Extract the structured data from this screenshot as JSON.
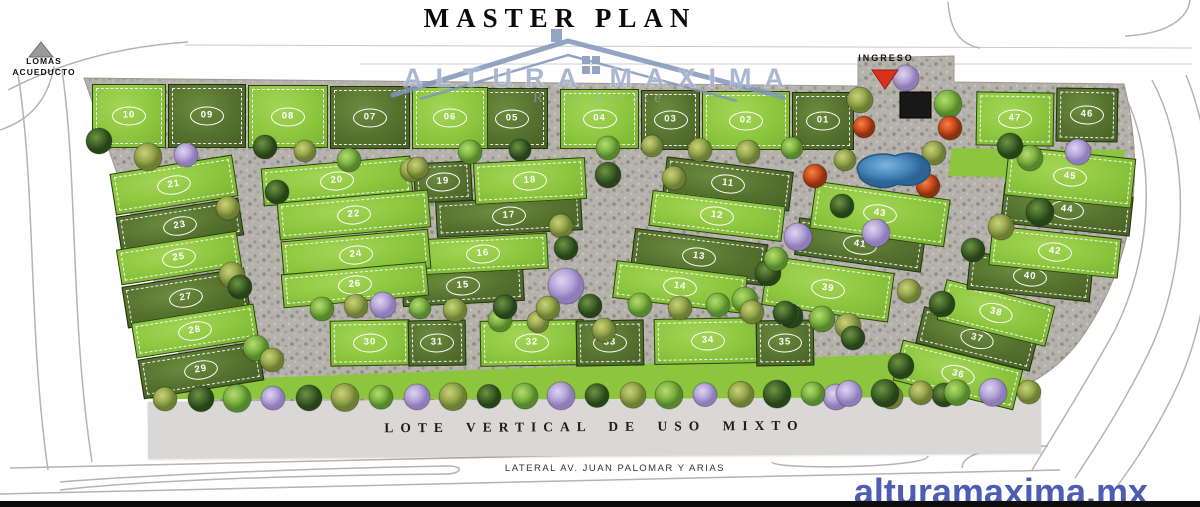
{
  "title": "MASTER PLAN",
  "brand": {
    "name": "ALTURA MAXIMA",
    "subtitle": "Real Estate",
    "website": "alturamaxima.mx"
  },
  "labels": {
    "top_left_road": "LOMAS ACUEDUCTO",
    "entrance": "INGRESO",
    "mixed_use_strip": "LOTE VERTICAL DE USO MIXTO",
    "bottom_road": "LATERAL AV. JUAN PALOMAR Y ARIAS"
  },
  "colors": {
    "lot_light": "#8cc63f",
    "lot_dark": "#55702e",
    "road": "#b5b2ab",
    "pond": "#4a89bd",
    "entrance_arrow_red": "#d8321c",
    "brand_blue": "#4d5db2",
    "watermark_blue": "#8b9abf",
    "strip_gray": "#d9d8d6"
  },
  "lots": [
    {
      "id": "01",
      "shade": "dark"
    },
    {
      "id": "02",
      "shade": "light"
    },
    {
      "id": "03",
      "shade": "dark"
    },
    {
      "id": "04",
      "shade": "light"
    },
    {
      "id": "05",
      "shade": "dark"
    },
    {
      "id": "06",
      "shade": "light"
    },
    {
      "id": "07",
      "shade": "dark"
    },
    {
      "id": "08",
      "shade": "light"
    },
    {
      "id": "09",
      "shade": "dark"
    },
    {
      "id": "10",
      "shade": "light"
    },
    {
      "id": "11",
      "shade": "dark"
    },
    {
      "id": "12",
      "shade": "light"
    },
    {
      "id": "13",
      "shade": "dark"
    },
    {
      "id": "14",
      "shade": "light"
    },
    {
      "id": "15",
      "shade": "dark"
    },
    {
      "id": "16",
      "shade": "light"
    },
    {
      "id": "17",
      "shade": "dark"
    },
    {
      "id": "18",
      "shade": "light"
    },
    {
      "id": "19",
      "shade": "dark"
    },
    {
      "id": "20",
      "shade": "light"
    },
    {
      "id": "21",
      "shade": "light"
    },
    {
      "id": "22",
      "shade": "light"
    },
    {
      "id": "23",
      "shade": "dark"
    },
    {
      "id": "24",
      "shade": "light"
    },
    {
      "id": "25",
      "shade": "light"
    },
    {
      "id": "26",
      "shade": "light"
    },
    {
      "id": "27",
      "shade": "dark"
    },
    {
      "id": "28",
      "shade": "light"
    },
    {
      "id": "29",
      "shade": "dark"
    },
    {
      "id": "30",
      "shade": "light"
    },
    {
      "id": "31",
      "shade": "dark"
    },
    {
      "id": "32",
      "shade": "light"
    },
    {
      "id": "33",
      "shade": "dark"
    },
    {
      "id": "34",
      "shade": "light"
    },
    {
      "id": "35",
      "shade": "dark"
    },
    {
      "id": "36",
      "shade": "light"
    },
    {
      "id": "37",
      "shade": "dark"
    },
    {
      "id": "38",
      "shade": "light"
    },
    {
      "id": "39",
      "shade": "light"
    },
    {
      "id": "40",
      "shade": "dark"
    },
    {
      "id": "41",
      "shade": "dark"
    },
    {
      "id": "42",
      "shade": "light"
    },
    {
      "id": "43",
      "shade": "light"
    },
    {
      "id": "44",
      "shade": "dark"
    },
    {
      "id": "45",
      "shade": "light"
    },
    {
      "id": "46",
      "shade": "dark"
    },
    {
      "id": "47",
      "shade": "light"
    }
  ]
}
